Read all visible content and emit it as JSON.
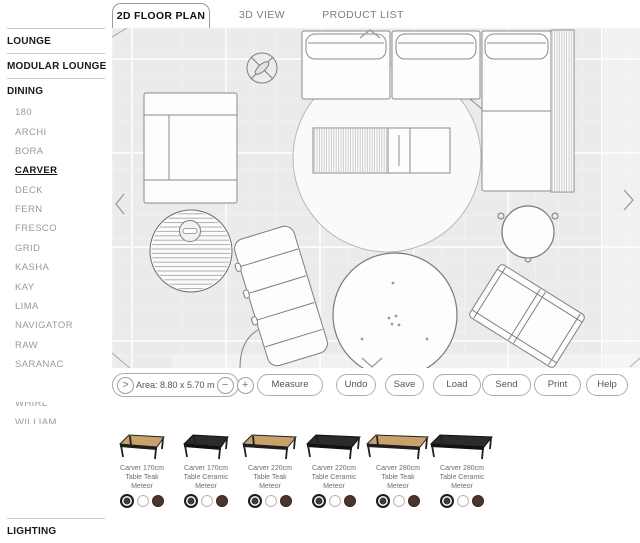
{
  "tabs": [
    {
      "label": "2D FLOOR PLAN"
    },
    {
      "label": "3D VIEW"
    },
    {
      "label": "PRODUCT LIST"
    }
  ],
  "sidebar": {
    "items": [
      {
        "label": "LOUNGE",
        "type": "header"
      },
      {
        "label": "MODULAR LOUNGE",
        "type": "header"
      },
      {
        "label": "DINING",
        "type": "header"
      },
      {
        "label": "180",
        "type": "sub"
      },
      {
        "label": "ARCHI",
        "type": "sub"
      },
      {
        "label": "BORA",
        "type": "sub"
      },
      {
        "label": "CARVER",
        "type": "sub",
        "selected": true
      },
      {
        "label": "DECK",
        "type": "sub"
      },
      {
        "label": "FERN",
        "type": "sub"
      },
      {
        "label": "FRESCO",
        "type": "sub"
      },
      {
        "label": "GRID",
        "type": "sub"
      },
      {
        "label": "KASHA",
        "type": "sub"
      },
      {
        "label": "KAY",
        "type": "sub"
      },
      {
        "label": "LIMA",
        "type": "sub"
      },
      {
        "label": "NAVIGATOR",
        "type": "sub"
      },
      {
        "label": "RAW",
        "type": "sub"
      },
      {
        "label": "SARANAC",
        "type": "sub"
      },
      {
        "label": "SWAY",
        "type": "sub"
      },
      {
        "label": "WHIRL",
        "type": "sub"
      },
      {
        "label": "WILLIAM",
        "type": "sub"
      },
      {
        "label": "OCCASIONAL TABLES",
        "type": "header"
      },
      {
        "label": "ACCESSORIES",
        "type": "header"
      },
      {
        "label": "PARASOLS",
        "type": "header"
      },
      {
        "label": "LIGHTING",
        "type": "header"
      }
    ]
  },
  "toolbar": {
    "area_label": "Area: 8.80 x 5.70 m",
    "expand_icon": ">",
    "zoom_out": "−",
    "zoom_in": "+",
    "buttons": [
      {
        "label": "Measure"
      },
      {
        "label": "Undo"
      },
      {
        "label": "Save"
      },
      {
        "label": "Load"
      },
      {
        "label": "Send"
      },
      {
        "label": "Print"
      },
      {
        "label": "Help"
      }
    ]
  },
  "products": {
    "items": [
      {
        "label": "Carver 170cm\nTable Teak\nMeteor",
        "finish": "teak",
        "size": "170cm"
      },
      {
        "label": "Carver 170cm\nTable Ceramic\nMeteor",
        "finish": "ceramic",
        "size": "170cm"
      },
      {
        "label": "Carver 220cm\nTable Teak\nMeteor",
        "finish": "teak",
        "size": "220cm"
      },
      {
        "label": "Carver 220cm\nTable Ceramic\nMeteor",
        "finish": "ceramic",
        "size": "220cm"
      },
      {
        "label": "Carver 280cm\nTable Teak\nMeteor",
        "finish": "teak",
        "size": "280cm"
      },
      {
        "label": "Carver 280cm\nTable Ceramic\nMeteor",
        "finish": "ceramic",
        "size": "280cm"
      }
    ],
    "swatches": [
      {
        "name": "meteor-black",
        "color": "#3b3b3b",
        "selected": true
      },
      {
        "name": "white",
        "color": "#ffffff",
        "selected": false
      },
      {
        "name": "java-brown",
        "color": "#4a342c",
        "selected": false
      }
    ]
  },
  "colors": {
    "canvas_background": "#ebebeb",
    "grid_line": "#f6f6f6",
    "outline": "#8a8a8a",
    "teak": "#c9a26b",
    "ceramic": "#2b2b2b"
  }
}
